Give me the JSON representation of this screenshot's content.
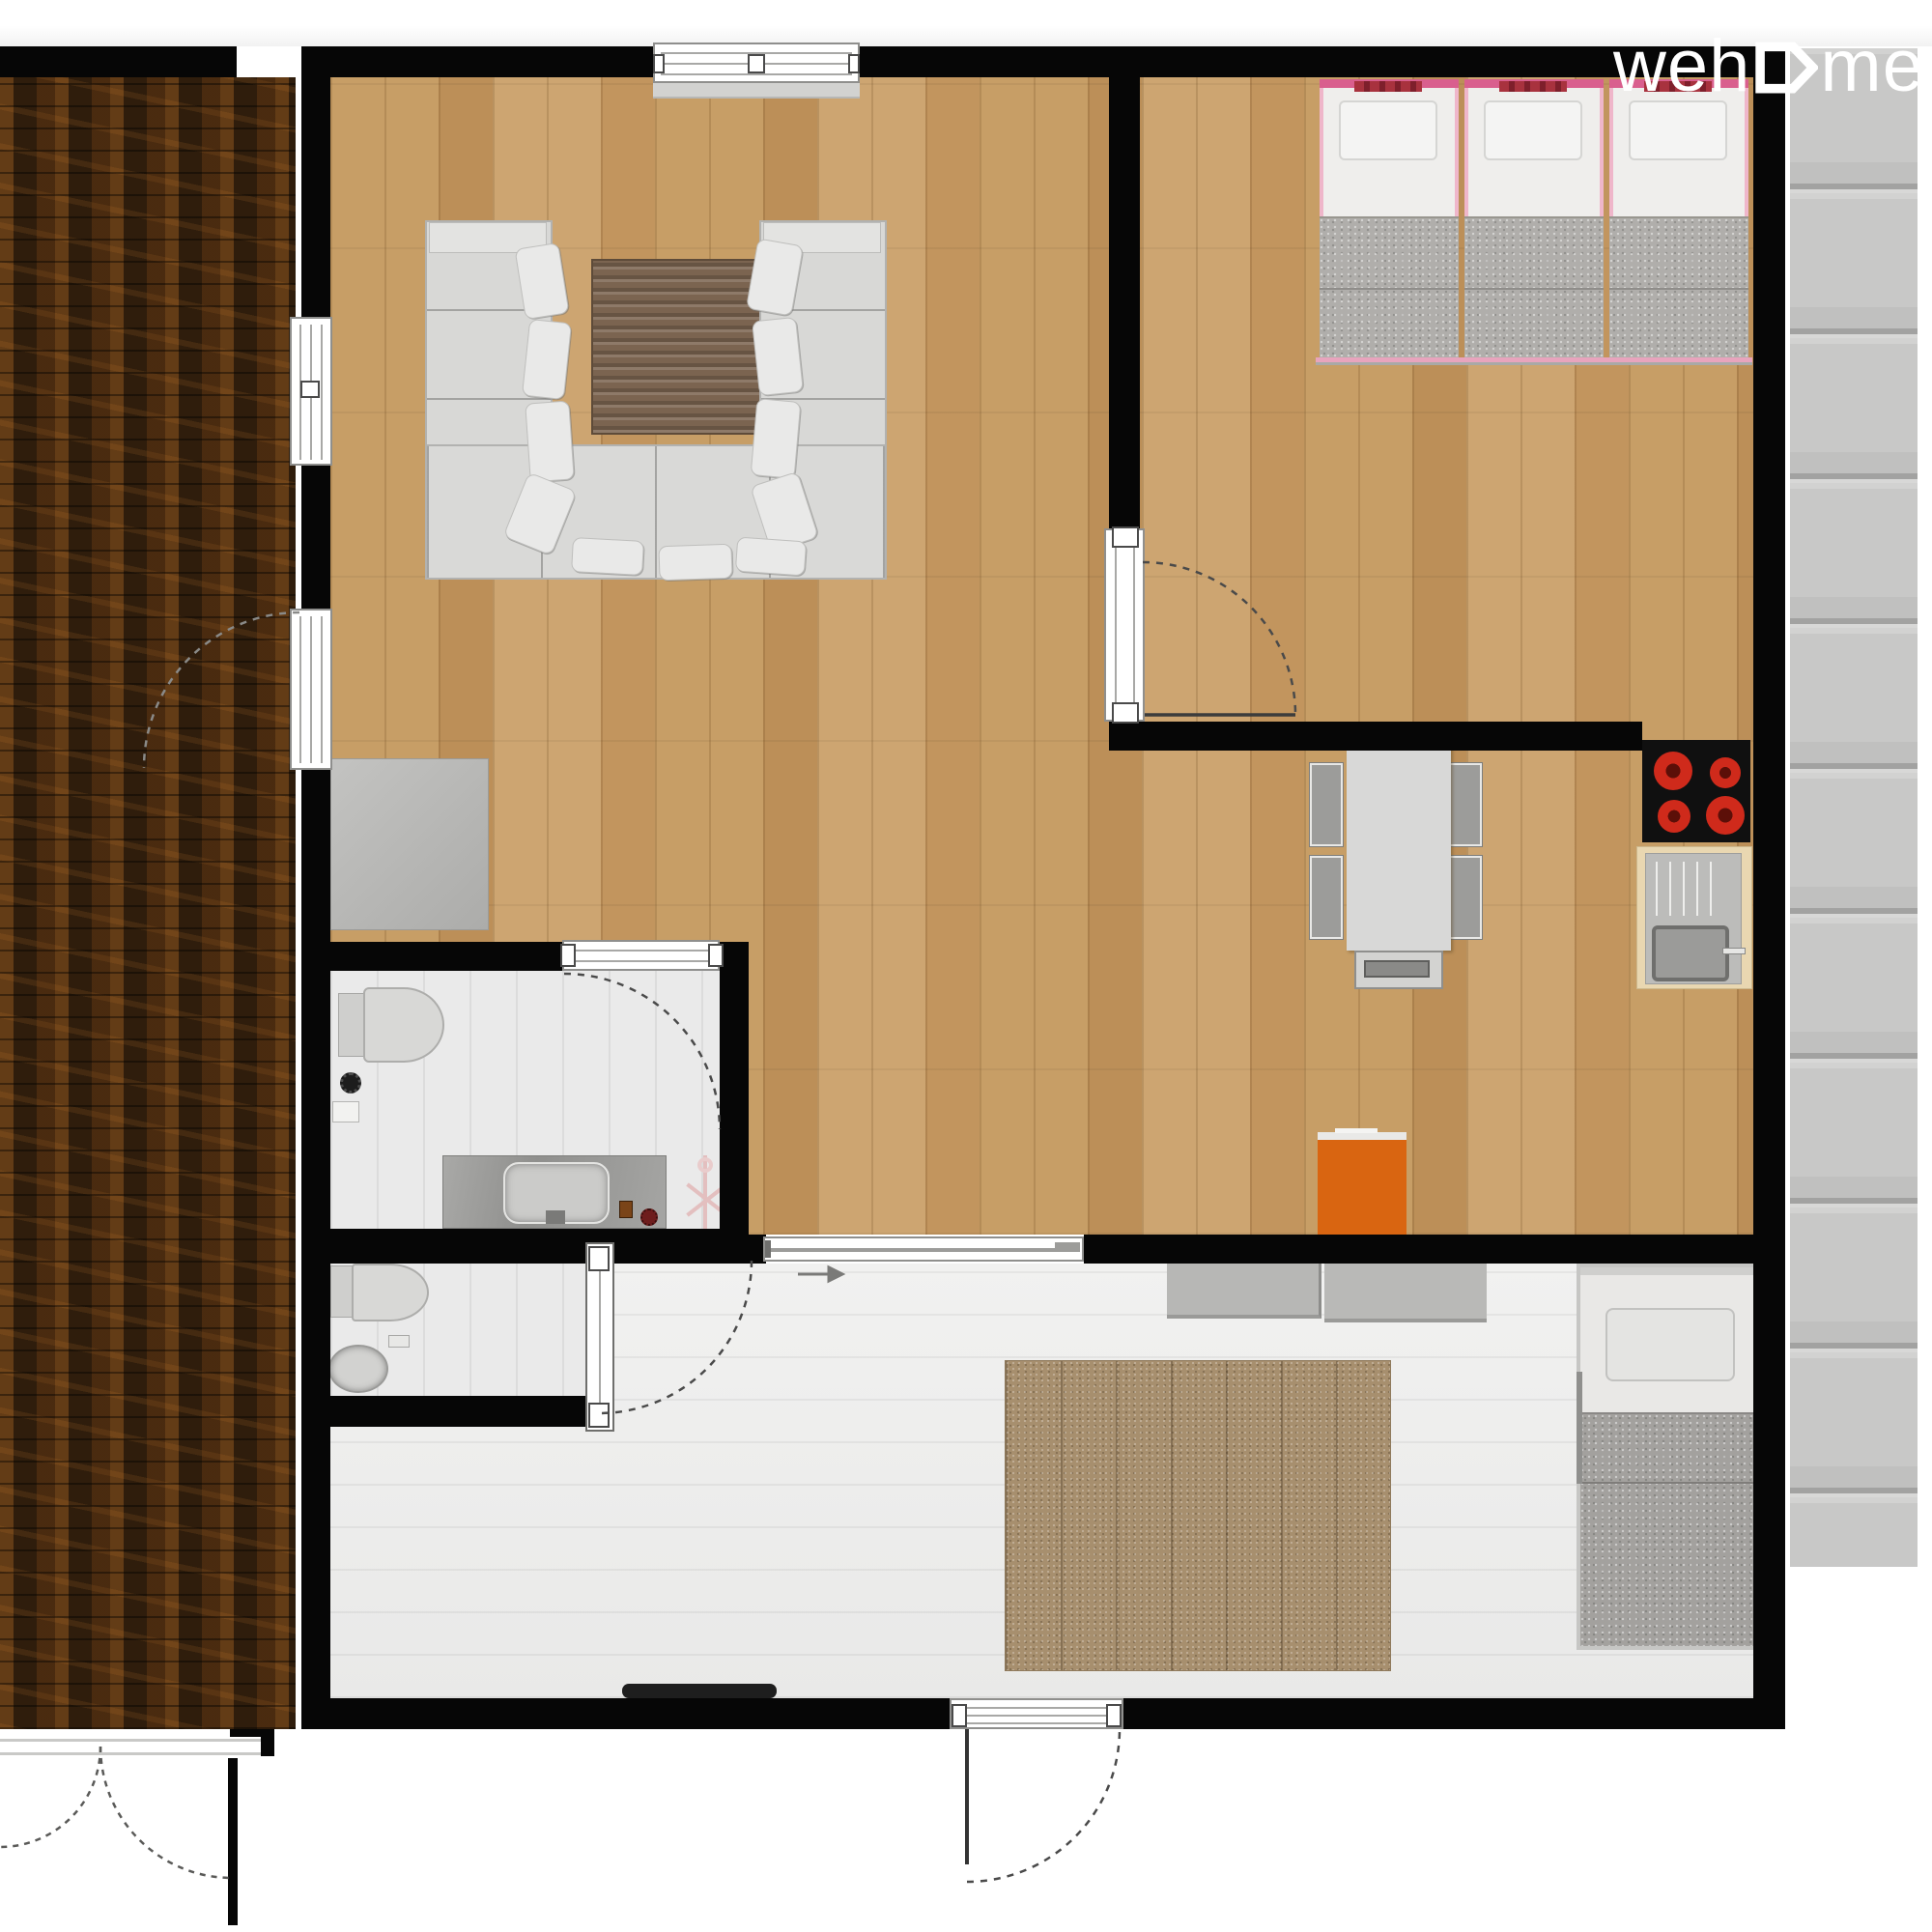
{
  "brand": {
    "logo_text_pre": "weh",
    "logo_text_post": "me",
    "logo_glyph": "house-arrow-icon",
    "logo_color": "#ffffff"
  },
  "palette": {
    "wall": "#060606",
    "wood-floor": "#c59c64",
    "deck-dark": "#2f1d0c",
    "entry-floor": "#ededec",
    "bath-floor": "#eaeaea",
    "terrace-gray": "#c6c6c5",
    "sofa-gray": "#d8d8d6",
    "coffee-table-brown": "#7b6450",
    "bed-pink": "#efb6ca",
    "bed-pink-dark": "#d95f8e",
    "bed-red-pattern": "#a8323e",
    "blanket-gray": "#b0aeab",
    "burner-red": "#cf2a1b",
    "cooktop-black": "#101010",
    "counter-wood": "#e9d7b1",
    "steel-gray": "#b9b9b7",
    "orange-accent": "#d96511",
    "rug-tan": "#a78f6e",
    "rack-pink": "#e3bfbf",
    "arc-line": "#4a4a4a"
  },
  "rooms": [
    {
      "name": "living-room",
      "floor": "wood",
      "furniture": [
        "u-shaped-sofa",
        "sofa-pillows",
        "coffee-table",
        "side-cabinet"
      ]
    },
    {
      "name": "bedroom",
      "floor": "wood",
      "furniture": [
        "single-bed-1",
        "single-bed-2",
        "single-bed-3"
      ]
    },
    {
      "name": "kitchen-dining",
      "floor": "wood",
      "furniture": [
        "cooktop-4-burners",
        "sink-counter",
        "dining-table",
        "four-chairs",
        "end-bench",
        "orange-cabinet"
      ]
    },
    {
      "name": "bathroom",
      "floor": "light-tile",
      "furniture": [
        "toilet",
        "floor-drain",
        "shelf",
        "stone-vanity",
        "basin",
        "drying-rack"
      ]
    },
    {
      "name": "wc",
      "floor": "light-tile",
      "furniture": [
        "toilet",
        "hand-basin",
        "shelf"
      ]
    },
    {
      "name": "entry-family-room",
      "floor": "light-plank",
      "furniture": [
        "storage-bench-1",
        "storage-bench-2",
        "area-rug",
        "single-bed",
        "doormat"
      ]
    },
    {
      "name": "deck-left",
      "floor": "dark-wood"
    },
    {
      "name": "terrace-right",
      "floor": "gray-plank"
    }
  ],
  "openings": {
    "windows": [
      "top-wall-window",
      "left-wall-window"
    ],
    "doors": [
      "deck-door",
      "bedroom-door",
      "bathroom-door",
      "wc-glass-door",
      "sliding-door-to-entry",
      "main-entrance-door",
      "deck-double-doors"
    ],
    "slide_arrow": "right"
  }
}
